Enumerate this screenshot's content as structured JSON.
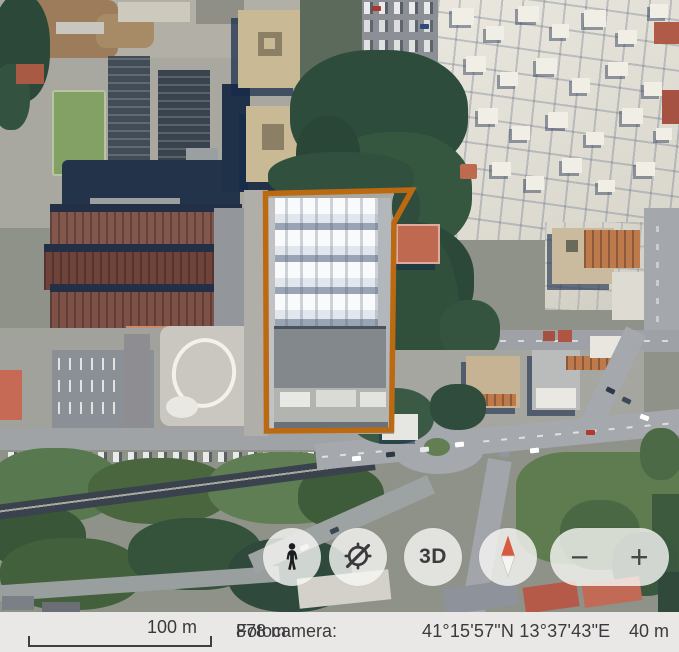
{
  "controls": {
    "three_d_label": "3D",
    "zoom_out_symbol": "−",
    "zoom_in_symbol": "+",
    "icons": {
      "look_around": "person-icon",
      "heading_off": "compass-dial-slash-icon",
      "compass": "north-needle-icon",
      "zoom_out": "minus-icon",
      "zoom_in": "plus-icon"
    },
    "compass_north_color": "#d85a41"
  },
  "highlight": {
    "outline_color": "#bc6a12"
  },
  "status_bar": {
    "scale_label": "100 m",
    "camera_label": "Fotocamera:",
    "camera_value": "878 m",
    "coordinates": "41°15'57\"N 13°37'43\"E",
    "altitude": "40 m",
    "background_color": "#e9e8e6",
    "text_color": "#3a3a3c"
  }
}
